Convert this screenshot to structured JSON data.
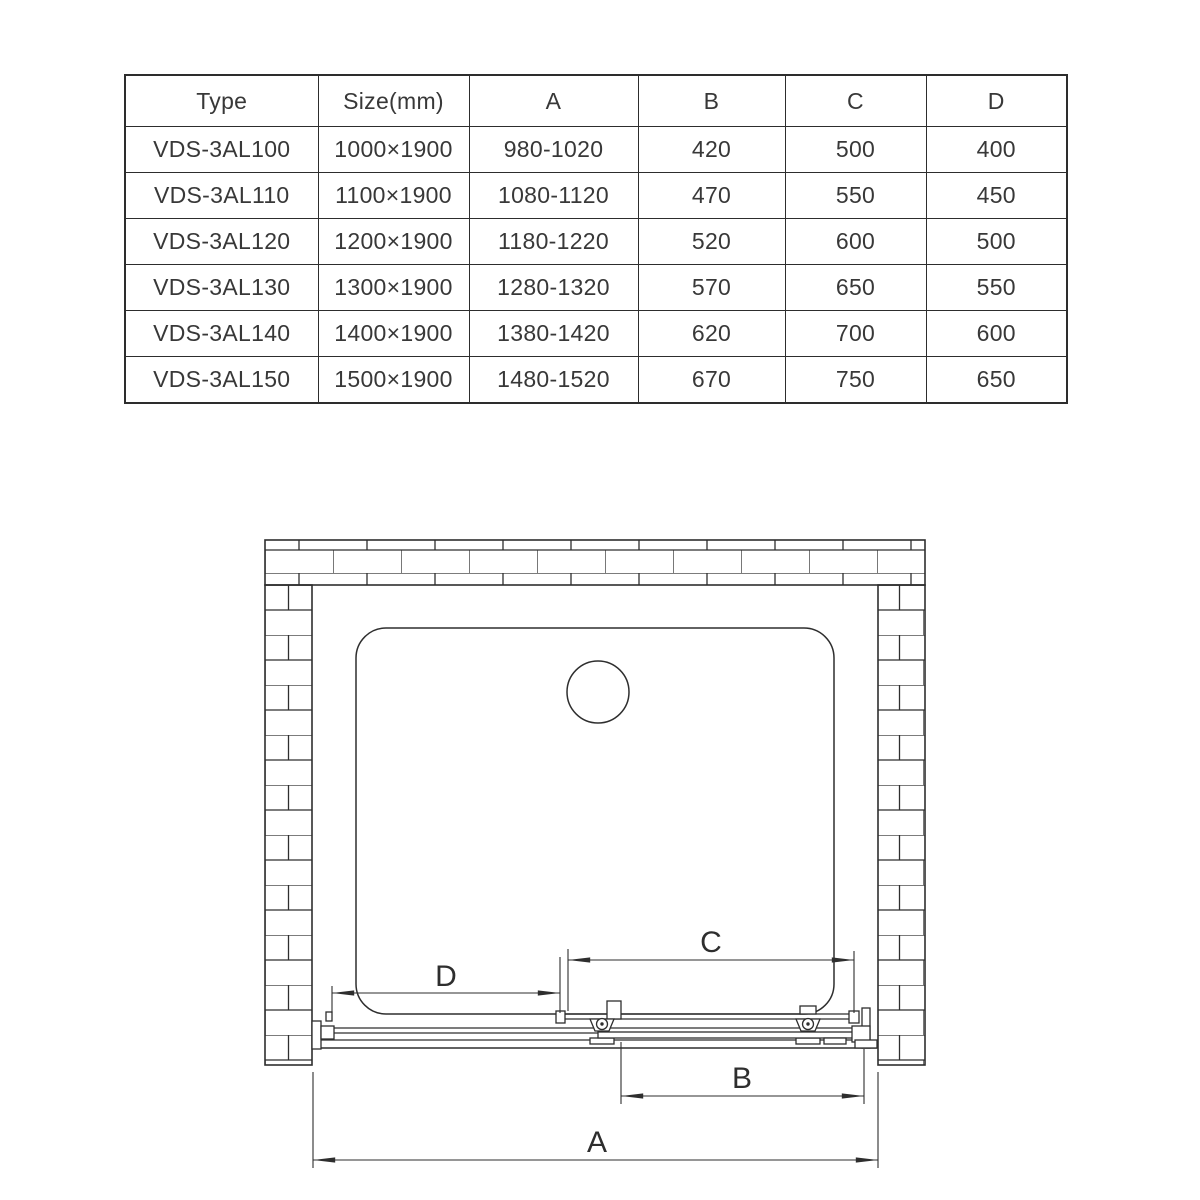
{
  "table": {
    "headers": [
      "Type",
      "Size(mm)",
      "A",
      "B",
      "C",
      "D"
    ],
    "rows": [
      [
        "VDS-3AL100",
        "1000×1900",
        "980-1020",
        "420",
        "500",
        "400"
      ],
      [
        "VDS-3AL110",
        "1100×1900",
        "1080-1120",
        "470",
        "550",
        "450"
      ],
      [
        "VDS-3AL120",
        "1200×1900",
        "1180-1220",
        "520",
        "600",
        "500"
      ],
      [
        "VDS-3AL130",
        "1300×1900",
        "1280-1320",
        "570",
        "650",
        "550"
      ],
      [
        "VDS-3AL140",
        "1400×1900",
        "1380-1420",
        "620",
        "700",
        "600"
      ],
      [
        "VDS-3AL150",
        "1500×1900",
        "1480-1520",
        "670",
        "750",
        "650"
      ]
    ]
  },
  "drawing": {
    "labels": {
      "a": "A",
      "b": "B",
      "c": "C",
      "d": "D"
    },
    "line_color": "#2e2e2e"
  }
}
